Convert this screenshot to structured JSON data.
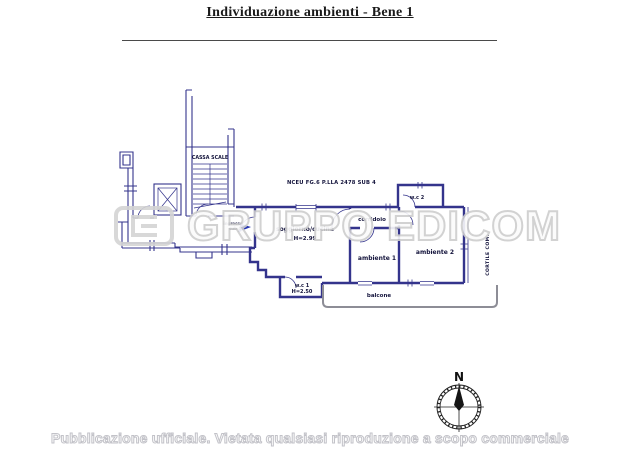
{
  "page": {
    "title": "Individuazione ambienti - Bene 1",
    "footer_notice": "Pubblicazione ufficiale. Vietata qualsiasi riproduzione a scopo commerciale"
  },
  "watermark": {
    "brand_part1": "GRUPPO",
    "brand_part2": "EDICOM",
    "color": "#cecece"
  },
  "plan": {
    "cadastral_ref": "NCEU FG.6  P.LLA 2478 SUB 4",
    "wall_color": "#34348c",
    "balcony_color": "#8d8d96",
    "labels": {
      "stairwell": "CASSA SCALE",
      "living_kitchen": "soggiorno/cucina",
      "living_kitchen_height": "H=2.99",
      "corridor": "corridoio",
      "room1": "ambiente 1",
      "room2": "ambiente 2",
      "wc1": "w.c 1",
      "wc1_height": "H=2.50",
      "wc2": "w.c 2",
      "balcony": "balcone",
      "entrance_line1": "ingresso",
      "entrance_line2": "sub 4",
      "courtyard": "CORTILE COM.",
      "compass_north": "N"
    }
  }
}
